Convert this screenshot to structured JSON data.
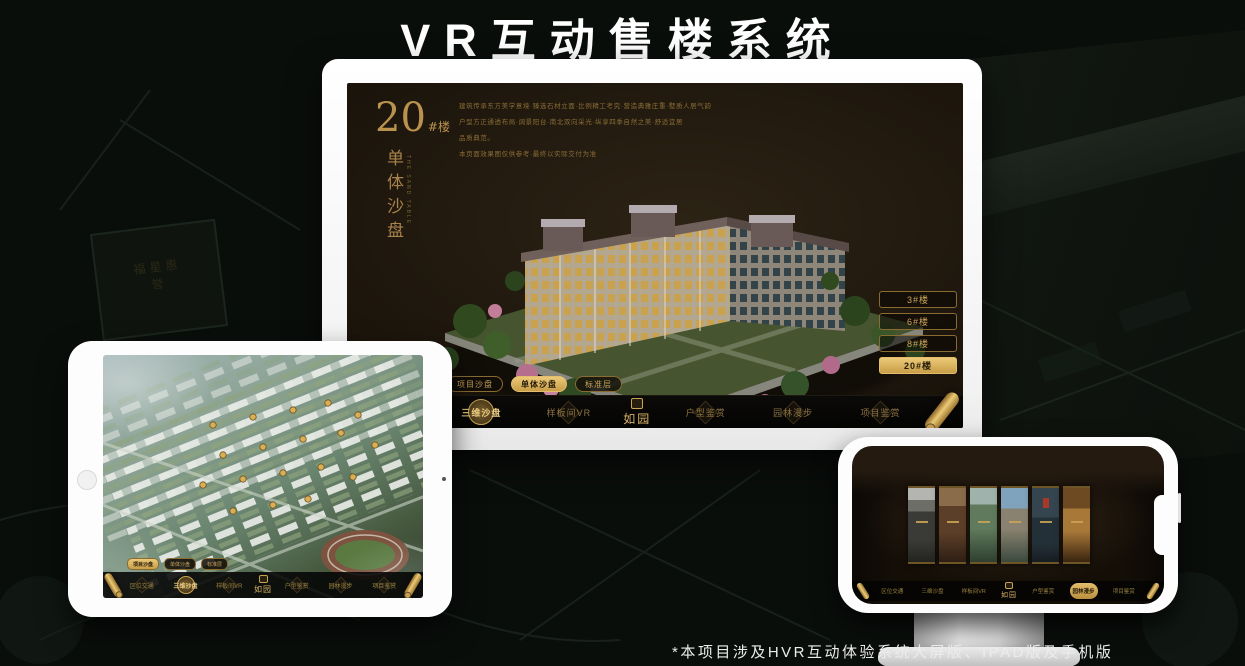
{
  "poster": {
    "title": "VR互动售楼系统",
    "footnote": "*本项目涉及HVR互动体验系统大屏版、IPAD版及手机版",
    "background_sign_text": "福星惠誉"
  },
  "colors": {
    "gold": "#c79a4e",
    "gold_bright": "#ecca79",
    "screen_background": "#221a0f",
    "poster_background": "#0a0e0b",
    "device_white": "#fdfdfd"
  },
  "monitor": {
    "screen": {
      "building_no": "20",
      "building_no_suffix": "#楼",
      "page_title": "单体沙盘",
      "page_title_en": "THE SAND TABLE",
      "description_lines": [
        "建筑传承东方美学意境·臻选石材立面·比例精工考究·营造典雅庄重·墅质人居气韵",
        "户型方正通透布局·阔景阳台·南北双向采光·纵享四季自然之美·舒适宜居",
        "品质典范。",
        "本页面效果图仅供参考·最终以实际交付为准"
      ],
      "building_buttons": [
        {
          "label": "3#楼",
          "active": false
        },
        {
          "label": "6#楼",
          "active": false
        },
        {
          "label": "8#楼",
          "active": false
        },
        {
          "label": "20#楼",
          "active": true
        }
      ],
      "tabs": [
        {
          "label": "项目沙盘",
          "active": false
        },
        {
          "label": "单体沙盘",
          "active": true
        },
        {
          "label": "标准层",
          "active": false
        }
      ],
      "menu": {
        "logo": "如园",
        "items": [
          {
            "label": "区位交通",
            "active": false
          },
          {
            "label": "三维沙盘",
            "active": true
          },
          {
            "label": "样板间VR",
            "active": false
          },
          {
            "label": "户型鉴赏",
            "active": false
          },
          {
            "label": "园林漫步",
            "active": false
          },
          {
            "label": "项目鉴赏",
            "active": false
          }
        ]
      }
    }
  },
  "tablet": {
    "tabs": [
      {
        "label": "项目沙盘",
        "active": true
      },
      {
        "label": "单体沙盘",
        "active": false
      },
      {
        "label": "标准层",
        "active": false
      }
    ],
    "menu": {
      "logo": "如园",
      "items": [
        {
          "label": "区位交通",
          "active": false
        },
        {
          "label": "三维沙盘",
          "active": true
        },
        {
          "label": "样板间VR",
          "active": false
        },
        {
          "label": "户型鉴赏",
          "active": false
        },
        {
          "label": "园林漫步",
          "active": false
        },
        {
          "label": "项目鉴赏",
          "active": false
        }
      ]
    }
  },
  "phone": {
    "gallery_panel_count": 6,
    "menu": {
      "logo": "如园",
      "items": [
        {
          "label": "区位交通",
          "active": false
        },
        {
          "label": "三维沙盘",
          "active": false
        },
        {
          "label": "样板间VR",
          "active": false
        },
        {
          "label": "户型鉴赏",
          "active": false
        },
        {
          "label": "园林漫步",
          "active": true
        },
        {
          "label": "项目鉴赏",
          "active": false
        }
      ]
    }
  }
}
